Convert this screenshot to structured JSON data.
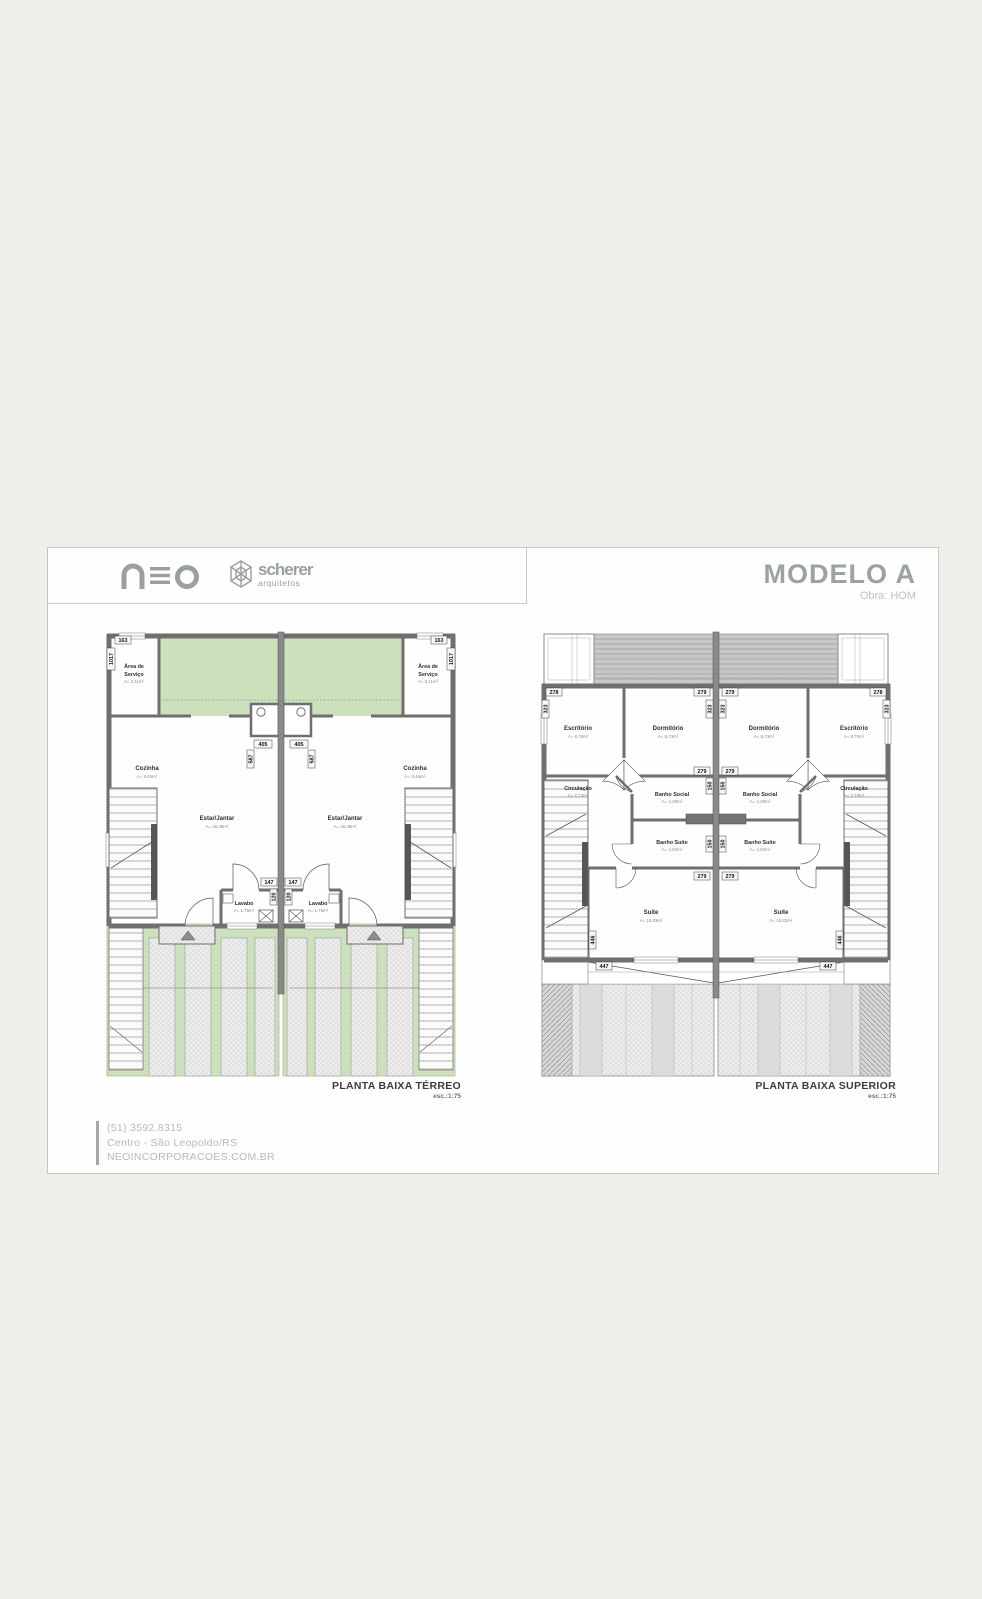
{
  "header": {
    "neo_logo": "neo",
    "scherer": {
      "name": "scherer",
      "subtitle": "arquitetos"
    },
    "title": "MODELO A",
    "subtitle": "Obra: HOM"
  },
  "footer": {
    "phone": "(51)   3592.8315",
    "address": "Centro - São Leopoldo/RS",
    "website": "NEOINCORPORACOES.COM.BR"
  },
  "terreo": {
    "caption": "PLANTA BAIXA TÉRREO",
    "scale": "esc.:1:75",
    "rooms": {
      "area_servico": {
        "l1": "Área de",
        "l2": "Serviço",
        "area": "A= 3,11m²"
      },
      "cozinha": {
        "name": "Cozinha",
        "area": "A= 9,46m²"
      },
      "estar": {
        "name": "Estar/Jantar",
        "area": "A= 28,38m²"
      },
      "lavabo": {
        "name": "Lavabo",
        "area": "A= 1,76m²"
      }
    },
    "dims": {
      "w163": "163",
      "h1017": "1017",
      "w405": "405",
      "h587": "587",
      "w147": "147",
      "h120": "120"
    }
  },
  "superior": {
    "caption": "PLANTA BAIXA SUPERIOR",
    "scale": "esc.:1:75",
    "rooms": {
      "escritorio": {
        "name": "Escritório",
        "area": "A= 8,75m²"
      },
      "dormitorio": {
        "name": "Dormitório",
        "area": "A= 8,73m²"
      },
      "circulacao": {
        "name": "Circulação",
        "area": "A= 2,73m²"
      },
      "banho_social": {
        "name": "Banho Social",
        "area": "A= 3,38m²"
      },
      "banho_suite": {
        "name": "Banho Suíte",
        "area": "A= 3,62m²"
      },
      "suite": {
        "name": "Suíte",
        "area": "A= 15,83m²"
      }
    },
    "dims": {
      "w278": "278",
      "w279": "279",
      "h323": "323",
      "h150": "150",
      "w447": "447",
      "h446": "446"
    }
  },
  "colors": {
    "green": "#cfe2bf",
    "wall": "#6f6f6f",
    "roof": "#c8c8c8",
    "title_gray": "#9ca2a2"
  }
}
